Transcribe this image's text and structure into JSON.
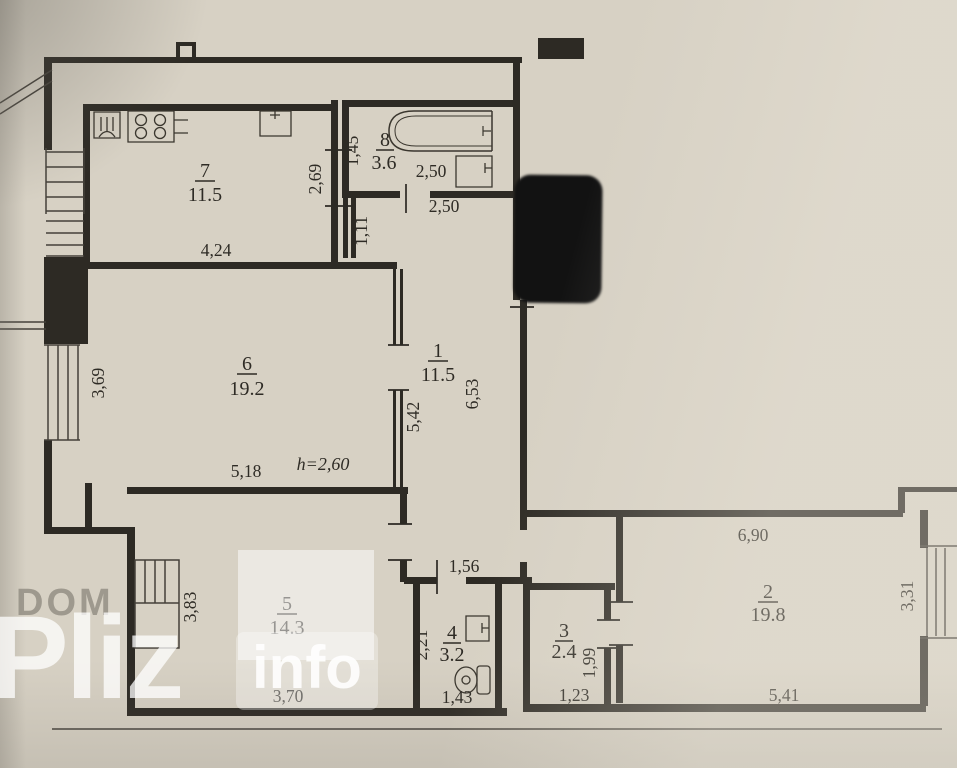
{
  "watermark": {
    "top": "DOM",
    "brand": "Pliz",
    "suffix": "info"
  },
  "rooms": [
    {
      "number": "1",
      "area": "11.5"
    },
    {
      "number": "2",
      "area": "19.8"
    },
    {
      "number": "3",
      "area": "2.4"
    },
    {
      "number": "4",
      "area": "3.2"
    },
    {
      "number": "5",
      "area": "14.3"
    },
    {
      "number": "6",
      "area": "19.2"
    },
    {
      "number": "7",
      "area": "11.5"
    },
    {
      "number": "8",
      "area": "3.6"
    }
  ],
  "dims": {
    "kitchen_width": "4,24",
    "kitchen_depth": "2,69",
    "bath_depth": "1,45",
    "bath_width_inner": "2,50",
    "bath_width_outer": "2,50",
    "corridor_width": "1,11",
    "room6_depth": "3,69",
    "room6_width": "5,18",
    "ceiling_height": "h=2,60",
    "hall_side": "5,42",
    "hall_length": "6,53",
    "hall_door": "1,56",
    "room5_depth": "3,83",
    "room5_width": "3,70",
    "room4_depth": "2,21",
    "room4_width": "1,43",
    "room3_door": "1,99",
    "room3_width": "1,23",
    "room2_top": "6,90",
    "room2_width": "5,41",
    "room2_depth": "3,31"
  }
}
